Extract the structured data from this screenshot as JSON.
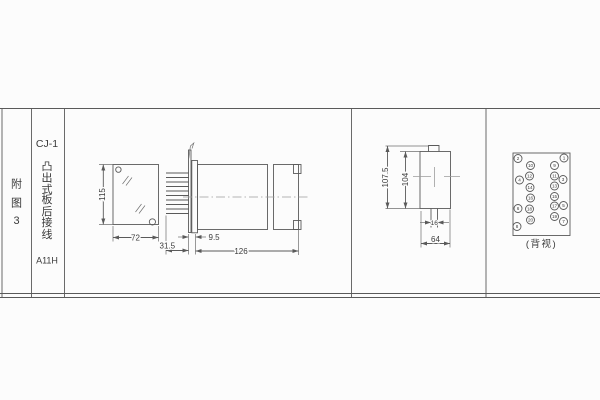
{
  "sidebar": {
    "figure_label": [
      "附",
      "图",
      "3"
    ],
    "model": "CJ-1",
    "subtitle_chars": [
      "凸",
      "出",
      "式",
      "板",
      "后",
      "接",
      "线"
    ],
    "code": "A11H"
  },
  "front_view": {
    "height": "115",
    "width": "72"
  },
  "side_view": {
    "pin_length": "31.5",
    "flange_depth": "9.5",
    "total_length": "126"
  },
  "mount_view": {
    "overall_height": "107.5",
    "body_height": "104",
    "slot_width": "16",
    "body_width": "64"
  },
  "back_view": {
    "caption": "(背视)",
    "outer_left": [
      "2",
      "4",
      "6",
      "8"
    ],
    "outer_right": [
      "1",
      "3",
      "5",
      "7"
    ],
    "inner_left": [
      "10",
      "12",
      "14",
      "16",
      "18",
      "20"
    ],
    "inner_right": [
      "9",
      "11",
      "13",
      "15",
      "17",
      "19"
    ]
  },
  "colors": {
    "line": "#5a5a5a",
    "text": "#3a3a3a",
    "centerline": "#9c9c9c",
    "background": "#fcfcfc"
  }
}
